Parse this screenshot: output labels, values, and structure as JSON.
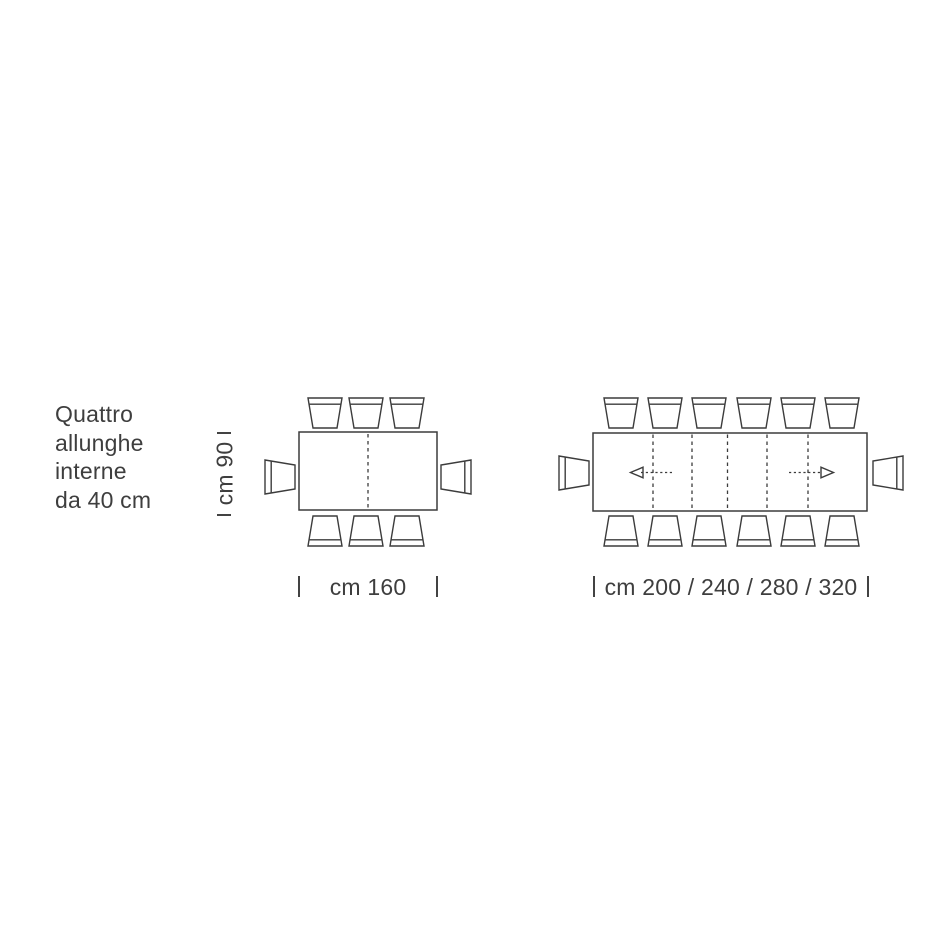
{
  "diagram": {
    "note_lines": [
      "Quattro",
      "allunghe",
      "interne",
      "da 40 cm"
    ],
    "closed_table": {
      "depth_label": "cm 90",
      "width_label": "cm 160",
      "seat_count": 8,
      "leaf_lines": 1
    },
    "extended_table": {
      "width_label": "cm 200 / 240 / 280 / 320",
      "seat_count": 14,
      "leaf_lines": 5,
      "has_extension_arrows": true
    },
    "colors": {
      "background": "#ffffff",
      "line": "#3c3c3c",
      "text": "#3e3e3e"
    }
  }
}
